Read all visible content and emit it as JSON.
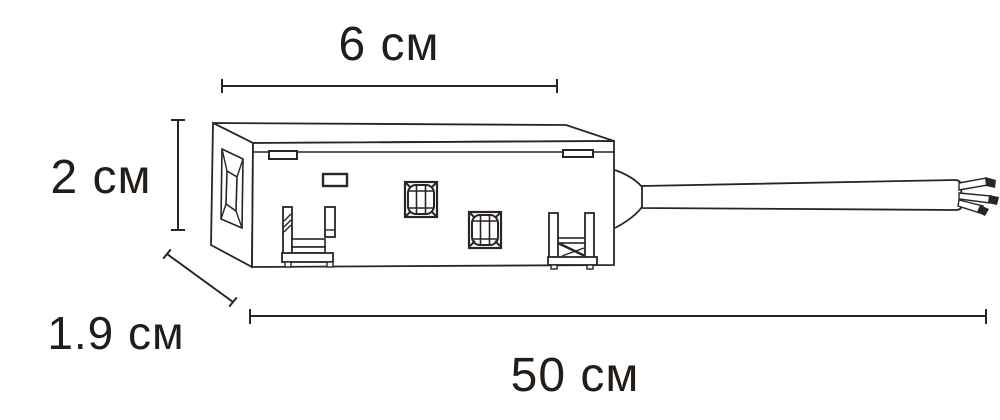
{
  "page": {
    "background_color": "#ffffff",
    "line_color": "#2a2522",
    "text_color": "#231d1a"
  },
  "drawing": {
    "kind": "technical-line-drawing",
    "subject": "connector-box-with-output-cable-and-stripped-wires"
  },
  "dimensions": {
    "width": {
      "label": "6 см"
    },
    "height": {
      "label": "2 см"
    },
    "depth": {
      "label": "1.9 см"
    },
    "cable_length": {
      "label": "50 см"
    }
  }
}
